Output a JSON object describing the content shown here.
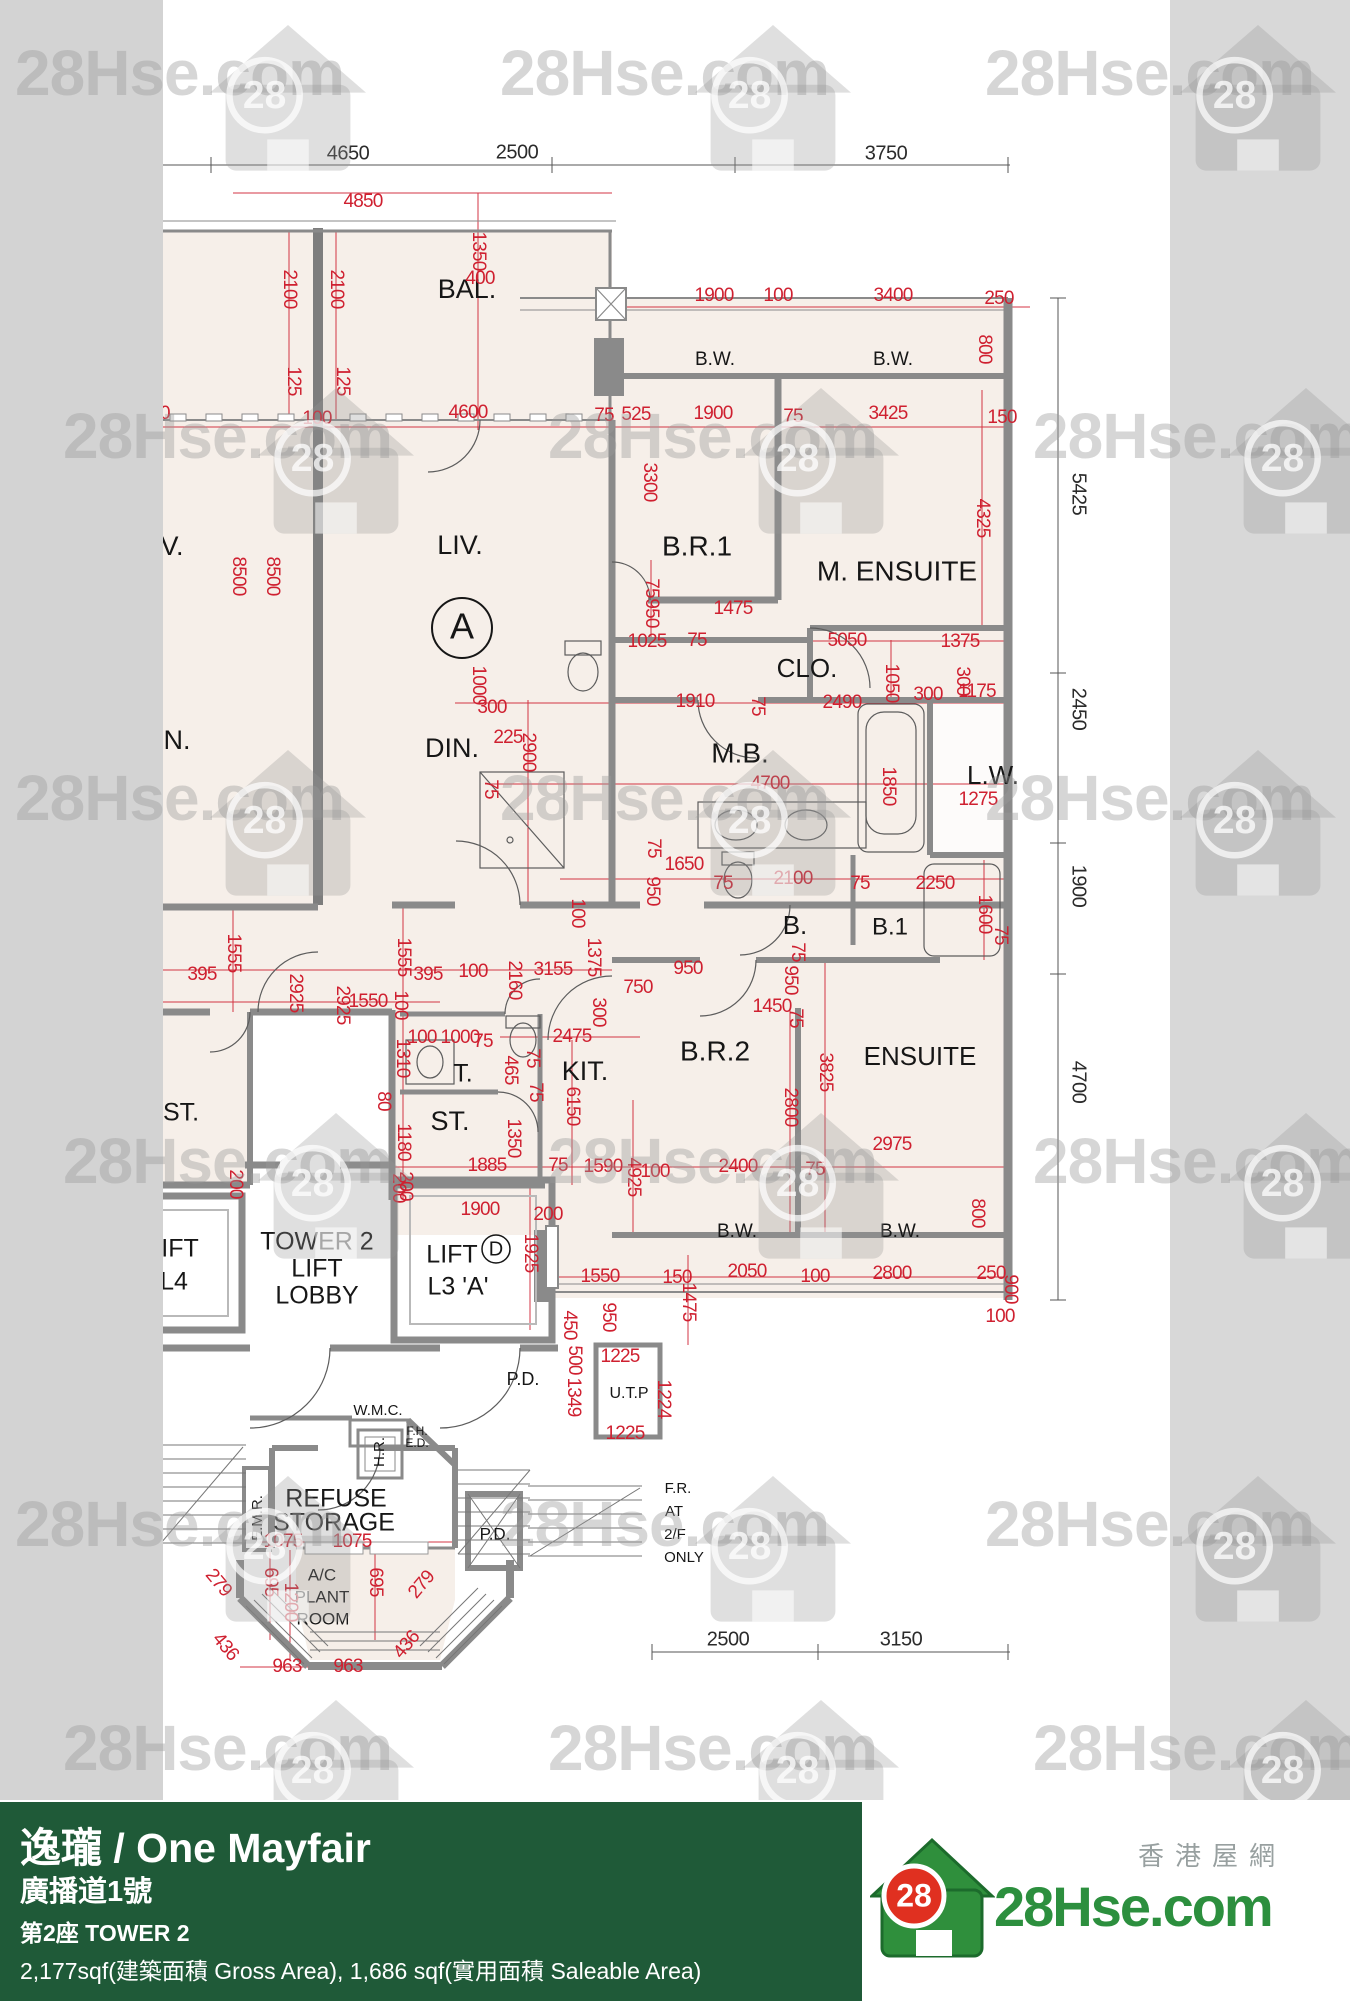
{
  "watermark": {
    "text": "28Hse.com",
    "badge": "28"
  },
  "brand": {
    "tagline_zh": "香港屋網",
    "logo_text": "28Hse.com",
    "badge": "28"
  },
  "footer": {
    "bg": "#1f5a38",
    "title": "逸瓏 / One Mayfair",
    "subtitle": "廣播道1號",
    "block": "第2座   TOWER 2",
    "area_line": "2,177sqf(建築面積 Gross Area), 1,686 sqf(實用面積 Saleable Area)"
  },
  "plan": {
    "colors": {
      "red": "#cf2030",
      "black": "#2b2b2b",
      "wall": "#8a8a8a",
      "room_fill": "#f6efe9",
      "strip": "#d3d3d3"
    },
    "unit_circle_labels": [
      [
        "A",
        462,
        628,
        30,
        36
      ],
      [
        "D",
        496,
        1249,
        14,
        20
      ]
    ],
    "room_labels": [
      [
        "BAL.",
        467,
        291,
        27,
        0
      ],
      [
        "L.",
        152,
        291,
        27,
        0
      ],
      [
        "LIV.",
        460,
        547,
        27,
        0
      ],
      [
        "V.",
        172,
        548,
        27,
        0
      ],
      [
        "DIN.",
        452,
        750,
        27,
        0
      ],
      [
        "N.",
        177,
        742,
        27,
        0
      ],
      [
        "B.W.",
        715,
        360,
        19,
        0
      ],
      [
        "B.W.",
        893,
        360,
        19,
        0
      ],
      [
        "B.R.1",
        697,
        548,
        28,
        0
      ],
      [
        "M. ENSUITE",
        897,
        573,
        28,
        0
      ],
      [
        "CLO.",
        807,
        670,
        26,
        0
      ],
      [
        "M.B.",
        740,
        755,
        28,
        0
      ],
      [
        "L.W.",
        993,
        777,
        26,
        0
      ],
      [
        "B.",
        795,
        927,
        26,
        0
      ],
      [
        "B.1",
        890,
        928,
        24,
        0
      ],
      [
        "B.R.2",
        715,
        1053,
        28,
        0
      ],
      [
        "ENSUITE",
        920,
        1058,
        26,
        0
      ],
      [
        "KIT.",
        585,
        1073,
        27,
        0
      ],
      [
        "T.",
        463,
        1075,
        25,
        0
      ],
      [
        "ST.",
        450,
        1123,
        27,
        0
      ],
      [
        "ST.",
        181,
        1114,
        25,
        0
      ],
      [
        "TOWER 2",
        317,
        1243,
        25,
        0
      ],
      [
        "LIFT",
        317,
        1270,
        25,
        0
      ],
      [
        "LOBBY",
        317,
        1297,
        25,
        0
      ],
      [
        "IFT",
        180,
        1250,
        25,
        0
      ],
      [
        "L4",
        174,
        1283,
        25,
        0
      ],
      [
        "LIFT",
        452,
        1256,
        25,
        0
      ],
      [
        "L3 'A'",
        458,
        1288,
        25,
        0
      ],
      [
        "P.D.",
        523,
        1380,
        18,
        0
      ],
      [
        "W.M.C.",
        378,
        1411,
        15,
        0
      ],
      [
        "F.H.",
        417,
        1432,
        12,
        0
      ],
      [
        "E.D.",
        417,
        1444,
        12,
        0
      ],
      [
        "H.R.",
        380,
        1452,
        15,
        -90
      ],
      [
        "E.M.R.",
        258,
        1518,
        15,
        -90
      ],
      [
        "REFUSE",
        336,
        1500,
        25,
        0
      ],
      [
        "STORAGE",
        334,
        1524,
        25,
        0
      ],
      [
        "A/C",
        322,
        1576,
        17,
        0
      ],
      [
        "PLANT",
        322,
        1598,
        17,
        0
      ],
      [
        "ROOM",
        323,
        1620,
        17,
        0
      ],
      [
        "P.D.",
        495,
        1535,
        17,
        0
      ],
      [
        "F.R.",
        678,
        1489,
        15,
        0
      ],
      [
        "AT",
        674,
        1512,
        15,
        0
      ],
      [
        "2/F",
        675,
        1535,
        15,
        0
      ],
      [
        "ONLY",
        684,
        1558,
        15,
        0
      ],
      [
        "B.W.",
        737,
        1232,
        19,
        0
      ],
      [
        "B.W.",
        900,
        1232,
        19,
        0
      ],
      [
        "U.T.P",
        629,
        1394,
        16,
        0
      ]
    ],
    "black_dims": [
      [
        "50",
        152,
        154,
        0
      ],
      [
        "4650",
        348,
        154,
        0
      ],
      [
        "2500",
        517,
        153,
        0
      ],
      [
        "3750",
        886,
        154,
        0
      ],
      [
        "5425",
        1078,
        494,
        90
      ],
      [
        "2450",
        1078,
        709,
        90
      ],
      [
        "1900",
        1078,
        886,
        90
      ],
      [
        "4700",
        1078,
        1082,
        90
      ],
      [
        "2500",
        728,
        1640,
        0
      ],
      [
        "3150",
        901,
        1640,
        0
      ]
    ],
    "red_dims": [
      [
        "0",
        150,
        202,
        0
      ],
      [
        "4850",
        363,
        202,
        0
      ],
      [
        "1350",
        478,
        251,
        90
      ],
      [
        "400",
        480,
        279,
        0
      ],
      [
        "1900",
        714,
        296,
        0
      ],
      [
        "100",
        778,
        296,
        0
      ],
      [
        "3400",
        893,
        296,
        0
      ],
      [
        "250",
        999,
        299,
        0
      ],
      [
        "800",
        984,
        349,
        90
      ],
      [
        "2100",
        289,
        289,
        90
      ],
      [
        "2100",
        336,
        289,
        90
      ],
      [
        "125",
        293,
        381,
        90
      ],
      [
        "125",
        342,
        381,
        90
      ],
      [
        "100",
        317,
        419,
        0
      ],
      [
        "00",
        160,
        414,
        0
      ],
      [
        "4600",
        468,
        413,
        0
      ],
      [
        "75",
        604,
        416,
        0
      ],
      [
        "525",
        636,
        415,
        0
      ],
      [
        "1900",
        713,
        414,
        0
      ],
      [
        "75",
        793,
        417,
        0
      ],
      [
        "3425",
        888,
        414,
        0
      ],
      [
        "150",
        1002,
        418,
        0
      ],
      [
        "3300",
        649,
        482,
        90
      ],
      [
        "4325",
        982,
        518,
        90
      ],
      [
        "8500",
        238,
        576,
        90
      ],
      [
        "8500",
        272,
        576,
        90
      ],
      [
        "75",
        651,
        588,
        90
      ],
      [
        "950",
        651,
        613,
        90
      ],
      [
        "1475",
        733,
        609,
        0
      ],
      [
        "1025",
        647,
        642,
        0
      ],
      [
        "75",
        697,
        641,
        0
      ],
      [
        "5050",
        847,
        641,
        0
      ],
      [
        "1375",
        960,
        642,
        0
      ],
      [
        "300",
        962,
        681,
        90
      ],
      [
        "1050",
        891,
        683,
        90
      ],
      [
        "300",
        928,
        695,
        0
      ],
      [
        "1175",
        977,
        692,
        0
      ],
      [
        "1000",
        478,
        685,
        90
      ],
      [
        "300",
        492,
        708,
        0
      ],
      [
        "225",
        508,
        738,
        0
      ],
      [
        "2900",
        528,
        752,
        90
      ],
      [
        "1910",
        695,
        702,
        0
      ],
      [
        "75",
        757,
        706,
        90
      ],
      [
        "2490",
        842,
        703,
        0
      ],
      [
        "75",
        490,
        789,
        90
      ],
      [
        "4700",
        770,
        784,
        0
      ],
      [
        "1850",
        888,
        786,
        90
      ],
      [
        "1275",
        978,
        800,
        0
      ],
      [
        "1650",
        684,
        865,
        0
      ],
      [
        "75",
        653,
        848,
        90
      ],
      [
        "950",
        652,
        891,
        90
      ],
      [
        "75",
        723,
        884,
        0
      ],
      [
        "2100",
        793,
        879,
        0
      ],
      [
        "75",
        860,
        884,
        0
      ],
      [
        "2250",
        935,
        884,
        0
      ],
      [
        "1600",
        984,
        914,
        90
      ],
      [
        "75",
        1000,
        935,
        90
      ],
      [
        "100",
        577,
        913,
        90
      ],
      [
        "1375",
        593,
        957,
        90
      ],
      [
        "1555",
        233,
        953,
        90
      ],
      [
        "1555",
        403,
        957,
        90
      ],
      [
        "395",
        202,
        975,
        0
      ],
      [
        "395",
        428,
        975,
        0
      ],
      [
        "100",
        473,
        972,
        0
      ],
      [
        "3155",
        553,
        970,
        0
      ],
      [
        "2160",
        514,
        980,
        90
      ],
      [
        "950",
        688,
        969,
        0
      ],
      [
        "750",
        638,
        988,
        0
      ],
      [
        "300",
        598,
        1012,
        90
      ],
      [
        "1450",
        772,
        1007,
        0
      ],
      [
        "75",
        797,
        952,
        90
      ],
      [
        "950",
        790,
        980,
        90
      ],
      [
        "75",
        795,
        1018,
        90
      ],
      [
        "2475",
        572,
        1037,
        0
      ],
      [
        "2925",
        295,
        993,
        90
      ],
      [
        "2925",
        342,
        1005,
        90
      ],
      [
        "1550",
        368,
        1002,
        0
      ],
      [
        "100",
        400,
        1005,
        90
      ],
      [
        "100",
        422,
        1038,
        0
      ],
      [
        "1000",
        460,
        1038,
        0
      ],
      [
        "75",
        483,
        1042,
        0
      ],
      [
        "1310",
        402,
        1058,
        90
      ],
      [
        "80",
        383,
        1101,
        90
      ],
      [
        "1180",
        403,
        1142,
        90
      ],
      [
        "200",
        405,
        1186,
        90
      ],
      [
        "465",
        510,
        1070,
        90
      ],
      [
        "75",
        532,
        1058,
        90
      ],
      [
        "75",
        535,
        1092,
        90
      ],
      [
        "6150",
        572,
        1106,
        90
      ],
      [
        "1350",
        513,
        1138,
        90
      ],
      [
        "1885",
        487,
        1166,
        0
      ],
      [
        "75",
        558,
        1166,
        0
      ],
      [
        "1590",
        603,
        1167,
        0
      ],
      [
        "4925",
        633,
        1177,
        90
      ],
      [
        "100",
        655,
        1172,
        0
      ],
      [
        "2400",
        738,
        1167,
        0
      ],
      [
        "75",
        815,
        1170,
        0
      ],
      [
        "2800",
        790,
        1107,
        90
      ],
      [
        "3825",
        825,
        1072,
        90
      ],
      [
        "2975",
        892,
        1145,
        0
      ],
      [
        "800",
        977,
        1213,
        90
      ],
      [
        "2050",
        747,
        1272,
        0
      ],
      [
        "100",
        815,
        1277,
        0
      ],
      [
        "2800",
        892,
        1274,
        0
      ],
      [
        "250",
        991,
        1274,
        0
      ],
      [
        "900",
        1010,
        1289,
        90
      ],
      [
        "100",
        1000,
        1317,
        0
      ],
      [
        "1550",
        600,
        1277,
        0
      ],
      [
        "150",
        677,
        1278,
        0
      ],
      [
        "1475",
        688,
        1302,
        90
      ],
      [
        "950",
        608,
        1317,
        90
      ],
      [
        "1225",
        620,
        1357,
        0
      ],
      [
        "1224",
        663,
        1399,
        90
      ],
      [
        "1225",
        625,
        1434,
        0
      ],
      [
        "450",
        569,
        1325,
        90
      ],
      [
        "500",
        574,
        1360,
        90
      ],
      [
        "1349",
        573,
        1397,
        90
      ],
      [
        "200",
        235,
        1184,
        90
      ],
      [
        "200",
        398,
        1188,
        90
      ],
      [
        "1900",
        480,
        1210,
        0
      ],
      [
        "200",
        548,
        1215,
        0
      ],
      [
        "1925",
        530,
        1253,
        90
      ],
      [
        "1075",
        283,
        1542,
        0
      ],
      [
        "1075",
        352,
        1542,
        0
      ],
      [
        "279",
        218,
        1583,
        50
      ],
      [
        "695",
        270,
        1582,
        90
      ],
      [
        "1200",
        290,
        1602,
        90
      ],
      [
        "695",
        375,
        1582,
        90
      ],
      [
        "279",
        422,
        1585,
        -50
      ],
      [
        "436",
        225,
        1647,
        50
      ],
      [
        "436",
        407,
        1645,
        -50
      ],
      [
        "963",
        287,
        1667,
        0
      ],
      [
        "963",
        348,
        1667,
        0
      ]
    ]
  }
}
